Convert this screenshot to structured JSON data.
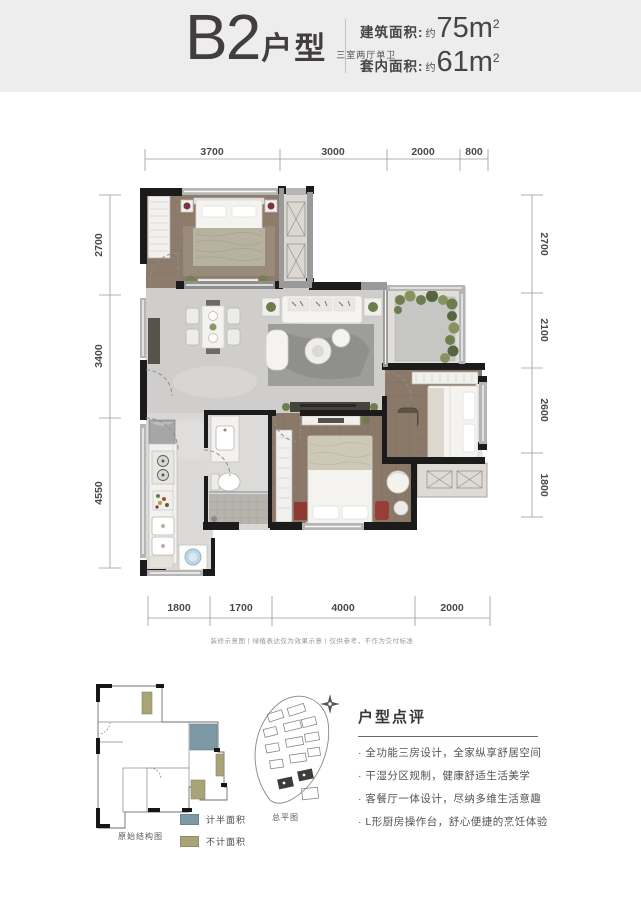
{
  "header": {
    "title": "B2",
    "title_suffix": "户型",
    "subtitle": "三室两厅单卫",
    "areas": [
      {
        "label": "建筑面积:",
        "approx": "约",
        "value": "75m",
        "sup": "2"
      },
      {
        "label": "套内面积:",
        "approx": "约",
        "value": "61m",
        "sup": "2"
      }
    ]
  },
  "plan": {
    "dims_top": [
      "3700",
      "3000",
      "2000",
      "800"
    ],
    "dims_left": [
      "2700",
      "3400",
      "4550"
    ],
    "dims_right": [
      "2700",
      "2100",
      "2600",
      "1800"
    ],
    "dims_bottom": [
      "1800",
      "1700",
      "4000",
      "2000"
    ],
    "disclaimer": "装修示意图丨绿植表达仅为效果示意丨仅供参考，不作为交付标准"
  },
  "footer": {
    "structure_caption": "原始结构图",
    "siteplan_caption": "总平图",
    "legend": [
      {
        "label": "计半面积",
        "color": "#7d9aa4"
      },
      {
        "label": "不计面积",
        "color": "#a9a378"
      }
    ],
    "review": {
      "title": "户型点评",
      "bullets": [
        "· 全功能三房设计，全家纵享舒居空间",
        "· 干湿分区规制，健康舒适生活美学",
        "· 客餐厅一体设计，尽纳多维生活意趣",
        "· L形厨房操作台，舒心便捷的烹饪体验"
      ]
    }
  },
  "colors": {
    "header_band": "#ededee",
    "wall_dark": "#1b1b1b",
    "wood_floor": "#8d7b6c",
    "tile_floor": "#cfcecc",
    "legend_half": "#7d9aa4",
    "legend_excluded": "#a9a378"
  }
}
